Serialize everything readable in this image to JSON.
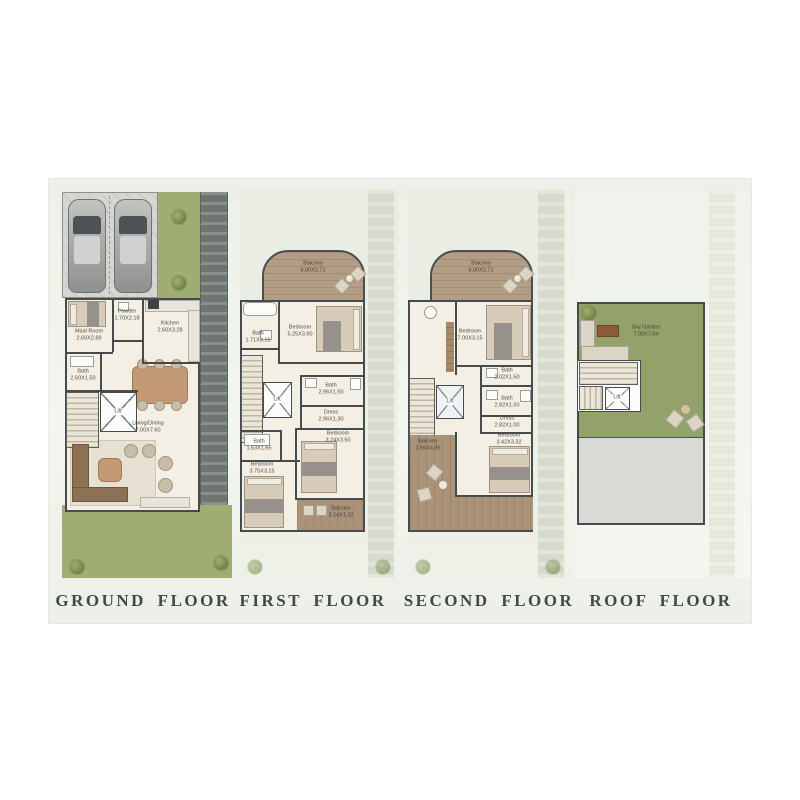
{
  "colors": {
    "panel_bg": "#eff2ea",
    "lawn_green": "#9fad72",
    "sky_garden_green": "#93a26b",
    "walkway_dark": "#70766f",
    "wood_deck": "#b49d85",
    "building_fill": "#f3efe5",
    "wall": "#464b4d",
    "roof_gray": "#d9dad6",
    "title_text": "#3e4c44"
  },
  "floors": [
    {
      "id": "ground",
      "title": "GROUND FLOOR",
      "rooms": {
        "maid": {
          "label": "Maid Room",
          "dims": "2.60X2.89"
        },
        "powder": {
          "label": "Powder",
          "dims": "1.70X2.18"
        },
        "kitchen": {
          "label": "Kitchen",
          "dims": "2.60X3.28"
        },
        "bath": {
          "label": "Bath",
          "dims": "2.60X1.50"
        },
        "living": {
          "label": "Living/Dining",
          "dims": "7.00X7.60"
        },
        "lift": {
          "label": "Lift"
        }
      }
    },
    {
      "id": "first",
      "title": "FIRST FLOOR",
      "rooms": {
        "balcony_top": {
          "label": "Balcony",
          "dims": "6.00X2.71"
        },
        "bath_top": {
          "label": "Bath",
          "dims": "1.71X3.15"
        },
        "bedroom_top": {
          "label": "Bedroom",
          "dims": "5.25X3.90"
        },
        "bath_mid": {
          "label": "Bath",
          "dims": "2.96X1.50"
        },
        "dress": {
          "label": "Dress",
          "dims": "2.96X1.30"
        },
        "bedroom_right": {
          "label": "Bedroom",
          "dims": "3.24X3.50"
        },
        "bath_left": {
          "label": "Bath",
          "dims": "1.63X1.65"
        },
        "bedroom_left": {
          "label": "Bedroom",
          "dims": "3.75X3.15"
        },
        "balcony_bottom": {
          "label": "Balcony",
          "dims": "3.24X1.32"
        },
        "lift": {
          "label": "Lift"
        }
      }
    },
    {
      "id": "second",
      "title": "SECOND FLOOR",
      "rooms": {
        "balcony_top": {
          "label": "Balcony",
          "dims": "6.00X2.71"
        },
        "bedroom_top": {
          "label": "Bedroom",
          "dims": "7.00X3.15"
        },
        "bath_upper": {
          "label": "Bath",
          "dims": "2.02X1.50"
        },
        "bath_lower": {
          "label": "Bath",
          "dims": "2.82X1.50"
        },
        "dress": {
          "label": "Dress",
          "dims": "2.82X1.00"
        },
        "bedroom_bottom": {
          "label": "Bedroom",
          "dims": "3.42X3.32"
        },
        "balcony_big": {
          "label": "Balcony",
          "dims": "3.56X4.85"
        },
        "lift": {
          "label": "Lift"
        }
      }
    },
    {
      "id": "roof",
      "title": "ROOF FLOOR",
      "rooms": {
        "sky_garden": {
          "label": "Sky Garden",
          "dims": "7.00X7.04"
        },
        "lift": {
          "label": "Lift"
        }
      }
    }
  ]
}
